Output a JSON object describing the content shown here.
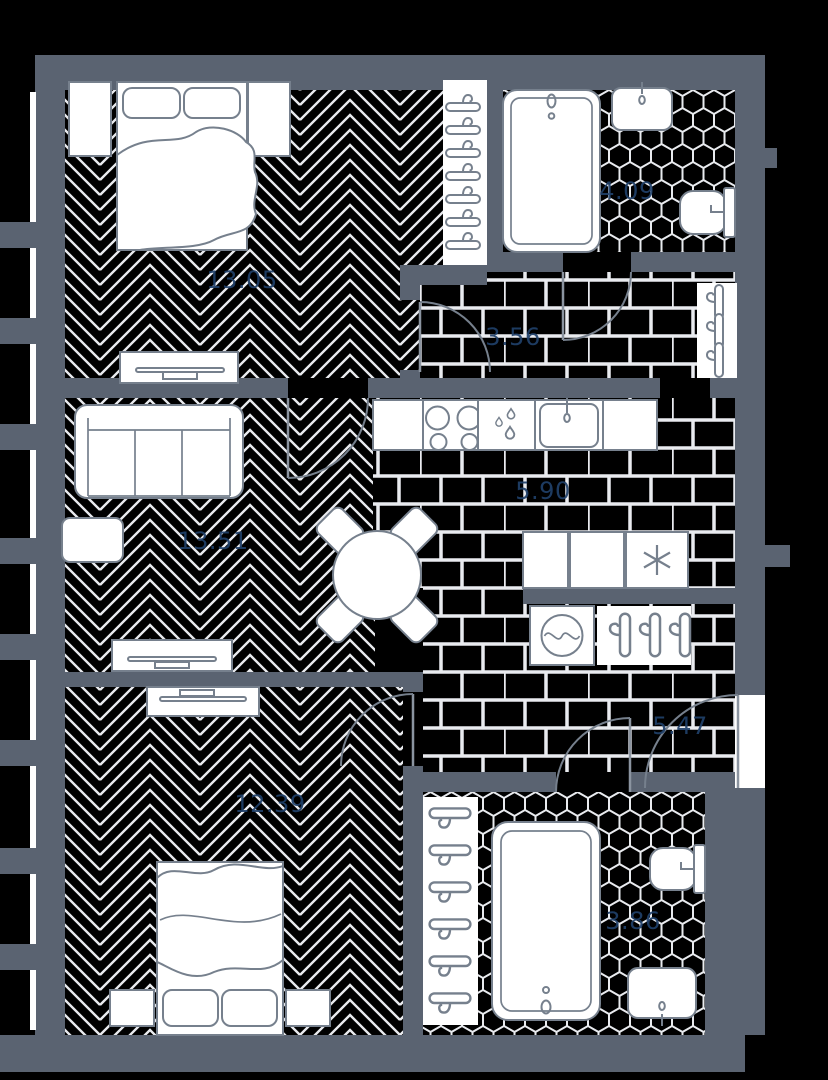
{
  "floorplan": {
    "type": "apartment-floor-plan",
    "rooms": [
      {
        "name": "bedroom-top",
        "area_label": "13.05",
        "floor": "herringbone-parquet",
        "furniture": [
          "double-bed",
          "pillows",
          "blanket",
          "nightstand",
          "nightstand",
          "tv-stand",
          "open-wardrobe-7-hangers"
        ]
      },
      {
        "name": "living-room",
        "area_label": "13.51",
        "floor": "herringbone-parquet",
        "furniture": [
          "three-seat-sofa",
          "coffee-table",
          "tv-stand"
        ]
      },
      {
        "name": "bedroom-bottom",
        "area_label": "12.39",
        "floor": "herringbone-parquet",
        "furniture": [
          "double-bed",
          "pillows",
          "blanket",
          "nightstand",
          "nightstand",
          "tv-stand"
        ]
      },
      {
        "name": "kitchen",
        "area_label": "5.90",
        "floor": "brick-tile",
        "furniture": [
          "counter-cabinet",
          "cooktop-4-burners",
          "dishwasher",
          "kitchen-sink",
          "counter-cabinet",
          "round-dining-table",
          "chair",
          "chair",
          "chair",
          "chair",
          "cabinet",
          "cabinet",
          "fridge-freezer"
        ]
      },
      {
        "name": "entry-corridor",
        "area_label": "3.56",
        "floor": "brick-tile",
        "furniture": [
          "coat-closet-3-hangers"
        ]
      },
      {
        "name": "bathroom-top",
        "area_label": "4.09",
        "floor": "hex-tile",
        "furniture": [
          "bathtub",
          "wash-basin",
          "toilet"
        ]
      },
      {
        "name": "hallway",
        "area_label": "5.47",
        "floor": "brick-tile",
        "furniture": [
          "washing-machine",
          "coat-rack-3-hangers",
          "entry-door"
        ]
      },
      {
        "name": "bathroom-bottom",
        "area_label": "3.86",
        "floor": "hex-tile",
        "furniture": [
          "hanger-strip-6-hangers",
          "bathtub",
          "toilet",
          "wash-basin"
        ]
      }
    ],
    "colors": {
      "background": "#000000",
      "wall": "#5a6371",
      "floor_line": "#e9ebef",
      "furniture_fill": "#ffffff",
      "furniture_stroke": "#76808d",
      "label": "#20406a"
    }
  }
}
